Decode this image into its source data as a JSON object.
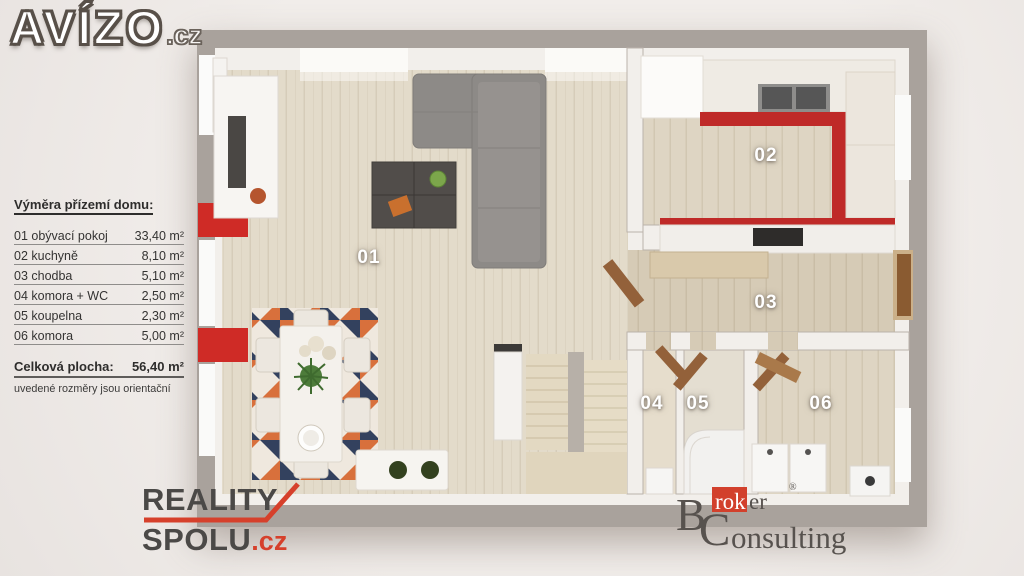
{
  "branding": {
    "avizo": {
      "name": "AVÍZO",
      "tld": ".cz"
    },
    "reality_spolu": {
      "line1": "REALITY",
      "line2": "SPOLU",
      "tld": ".cz"
    },
    "broker_consulting": {
      "initial1": "B",
      "red_part": "rok",
      "rest1": "er",
      "registered": "®",
      "initial2": "C",
      "rest2": "onsulting"
    }
  },
  "legend": {
    "title": "Výměra přízemí domu:",
    "rows": [
      {
        "name": "01 obývací pokoj",
        "area": "33,40 m²"
      },
      {
        "name": "02 kuchyně",
        "area": "8,10 m²"
      },
      {
        "name": "03 chodba",
        "area": "5,10 m²"
      },
      {
        "name": "04 komora + WC",
        "area": "2,50 m²"
      },
      {
        "name": "05 koupelna",
        "area": "2,30 m²"
      },
      {
        "name": "06 komora",
        "area": "5,00 m²"
      }
    ],
    "total_label": "Celková plocha:",
    "total_area": "56,40 m²",
    "note": "uvedené rozměry jsou orientační"
  },
  "floorplan": {
    "rooms": [
      {
        "label": "01"
      },
      {
        "label": "02"
      },
      {
        "label": "03"
      },
      {
        "label": "04"
      },
      {
        "label": "05"
      },
      {
        "label": "06"
      }
    ],
    "colors": {
      "accent_red": "#bf2a28",
      "wall_gray": "#a9a29c",
      "floor_wood": "#e3dbca",
      "logo_red": "#d6402b"
    }
  }
}
